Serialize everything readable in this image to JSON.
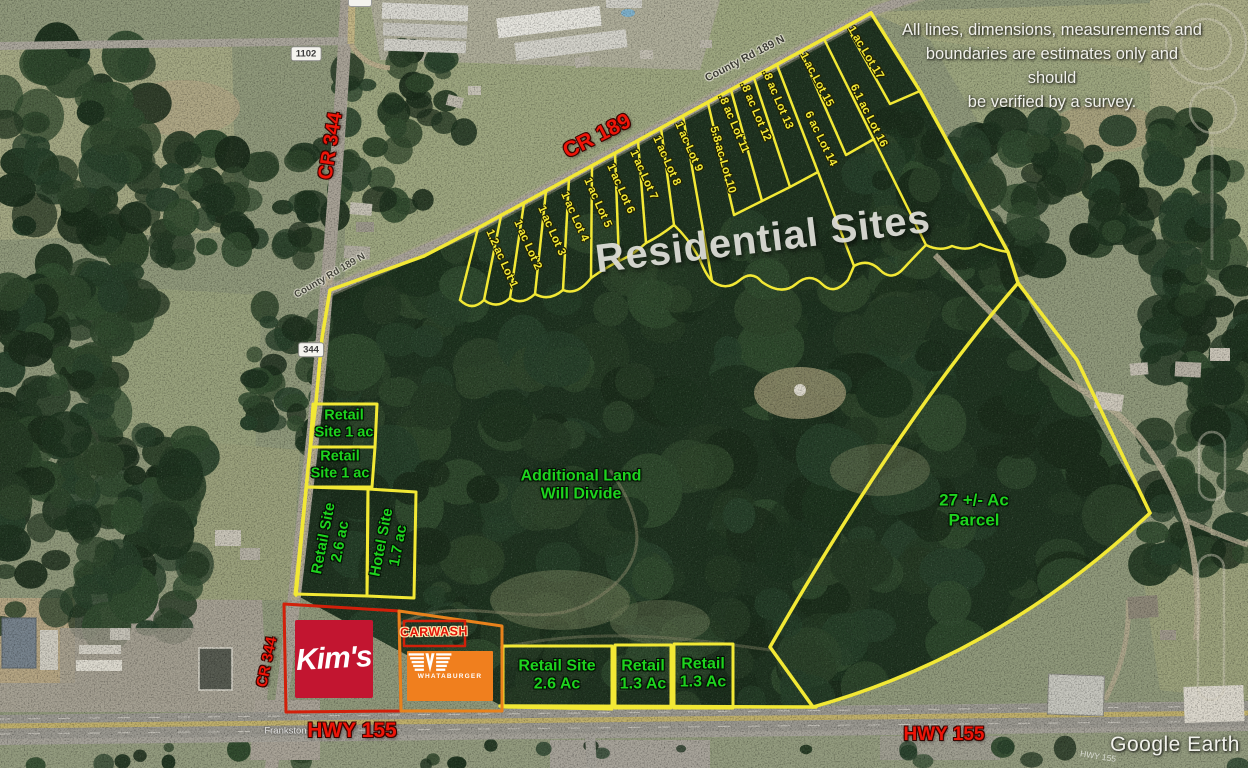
{
  "overlay": {
    "heading": "Residential Sites",
    "disclaimer": [
      "All lines, dimensions, measurements and",
      "boundaries are estimates only and should",
      "be verified by a survey."
    ],
    "watermark": "Google Earth"
  },
  "roads": {
    "cr189": "CR 189",
    "cr344": "CR 344",
    "hwy155": "HWY 155",
    "county_rd": "County Rd 189 N",
    "frankston_hwy": "Frankston Hwy",
    "hwy155_faint": "HWY 155",
    "shield_1102": "1102",
    "shield_344": "344"
  },
  "residential": {
    "lots": [
      "1.2 ac Lot 1",
      "1 ac Lot 2",
      "1 ac Lot 3",
      "1 ac Lot 4",
      "1 ac Lot 5",
      "1 ac Lot 6",
      "1 ac Lot 7",
      "1 ac Lot 8",
      "1 ac Lot 9",
      "5.8 ac Lot 10",
      ".8 ac Lot 11",
      ".8 ac Lot 12",
      ".8 ac Lot 13",
      "6 ac Lot 14",
      "1 ac Lot 15",
      "6.1 ac Lot 16",
      "1 ac Lot 17"
    ]
  },
  "sites": {
    "retail_1a": [
      "Retail",
      "Site 1 ac"
    ],
    "retail_1b": [
      "Retail",
      "Site 1 ac"
    ],
    "retail_26": [
      "Retail Site",
      "2.6 ac"
    ],
    "hotel": [
      "Hotel Site",
      "1.7 ac"
    ],
    "additional": [
      "Additional Land",
      "Will Divide"
    ],
    "parcel_27": [
      "27 +/- Ac",
      "Parcel"
    ],
    "retail_bottom_26": [
      "Retail Site",
      "2.6 Ac"
    ],
    "retail_bottom_13a": [
      "Retail",
      "1.3 Ac"
    ],
    "retail_bottom_13b": [
      "Retail",
      "1.3 Ac"
    ]
  },
  "brands": {
    "kims": "Kim's",
    "carwash": "CARWASH",
    "whataburger": "WHATABURGER"
  },
  "colors": {
    "boundary_yellow": "#f2e835",
    "label_green": "#1ed31e",
    "label_red": "#ee1508",
    "kims_red": "#c21530",
    "whataburger_orange": "#f07f1e"
  }
}
